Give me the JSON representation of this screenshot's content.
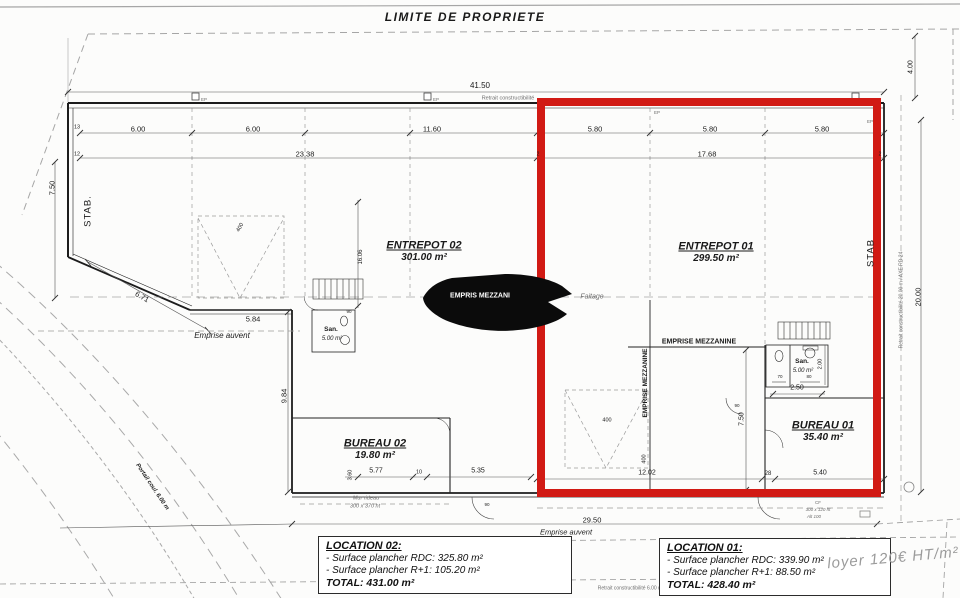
{
  "title": "LIMITE DE PROPRIETE",
  "rooms": {
    "entrepot02": {
      "name": "ENTREPOT 02",
      "area": "301.00 m²"
    },
    "entrepot01": {
      "name": "ENTREPOT 01",
      "area": "299.50 m²"
    },
    "bureau02": {
      "name": "BUREAU 02",
      "area": "19.80 m²"
    },
    "bureau01": {
      "name": "BUREAU 01",
      "area": "35.40 m²"
    },
    "san02": {
      "name": "San.",
      "area": "5.00 m²"
    },
    "san01": {
      "name": "San.",
      "area": "5.00 m²"
    }
  },
  "labels": {
    "stab_left": "STAB.",
    "stab_right": "STAB",
    "emprise_mezzanine": "EMPRISE MEZZANINE",
    "emprise_mezzanine_covered": "EMPRIS MEZZANI",
    "faitage": "Faitage",
    "emprise_auvent": "Emprise auvent",
    "retrait_top": "Retrait constructibilité",
    "retrait_bottom": "Retrait constructibilité 6.00 m",
    "retrait_right": "Retrait constructibilité 20.00 m / AXE RD 24",
    "mur_rideau_1": "Mur rideau",
    "mur_rideau_2": "300 x 370 ht",
    "cf_1": "CF",
    "cf_2": "300 x 120 ht",
    "cf_3": "Alt 100",
    "portail": "Portail coul. 6.00 m",
    "ep": "EP"
  },
  "note": {
    "handwritten": "loyer 120€ HT/m²"
  },
  "locations": {
    "loc02": {
      "title": "LOCATION 02:",
      "lines": [
        "- Surface plancher RDC: 325.80 m²",
        "- Surface plancher R+1: 105.20 m²"
      ],
      "total": "TOTAL: 431.00 m²"
    },
    "loc01": {
      "title": "LOCATION 01:",
      "lines": [
        "- Surface plancher RDC: 339.90 m²",
        "- Surface plancher R+1: 88.50 m²"
      ],
      "total": "TOTAL: 428.40 m²"
    }
  },
  "dims": {
    "overall": "41.50",
    "w13": "13",
    "w12": "12",
    "a600a": "6.00",
    "a600b": "6.00",
    "a1160": "11.60",
    "b580a": "5.80",
    "b580b": "5.80",
    "b580c": "5.80",
    "c2338": "23.38",
    "c1768": "17.68",
    "c2a": "2",
    "c2b": "2",
    "v750l": "7.50",
    "d671": "6.71",
    "d584": "5.84",
    "v984": "9.84",
    "v1606": "16.06",
    "v360": "3.60",
    "e577": "5.77",
    "e010": "10",
    "e535": "5.35",
    "f1202": "12.02",
    "f028": "28",
    "f540": "5.40",
    "g250": "2.50",
    "v750r": "7.50",
    "v200": "2.00",
    "g70": "70",
    "g80": "80",
    "g90a": "90",
    "g90b": "90",
    "g90c": "90",
    "h400a": "400",
    "h400b": "400",
    "h400c": "400",
    "w2950": "29.50",
    "v2000": "20.00",
    "v400tr": "4.00"
  },
  "colors": {
    "highlight_red": "#d11a14",
    "line_dark": "#222222",
    "line_gray": "#999999"
  }
}
